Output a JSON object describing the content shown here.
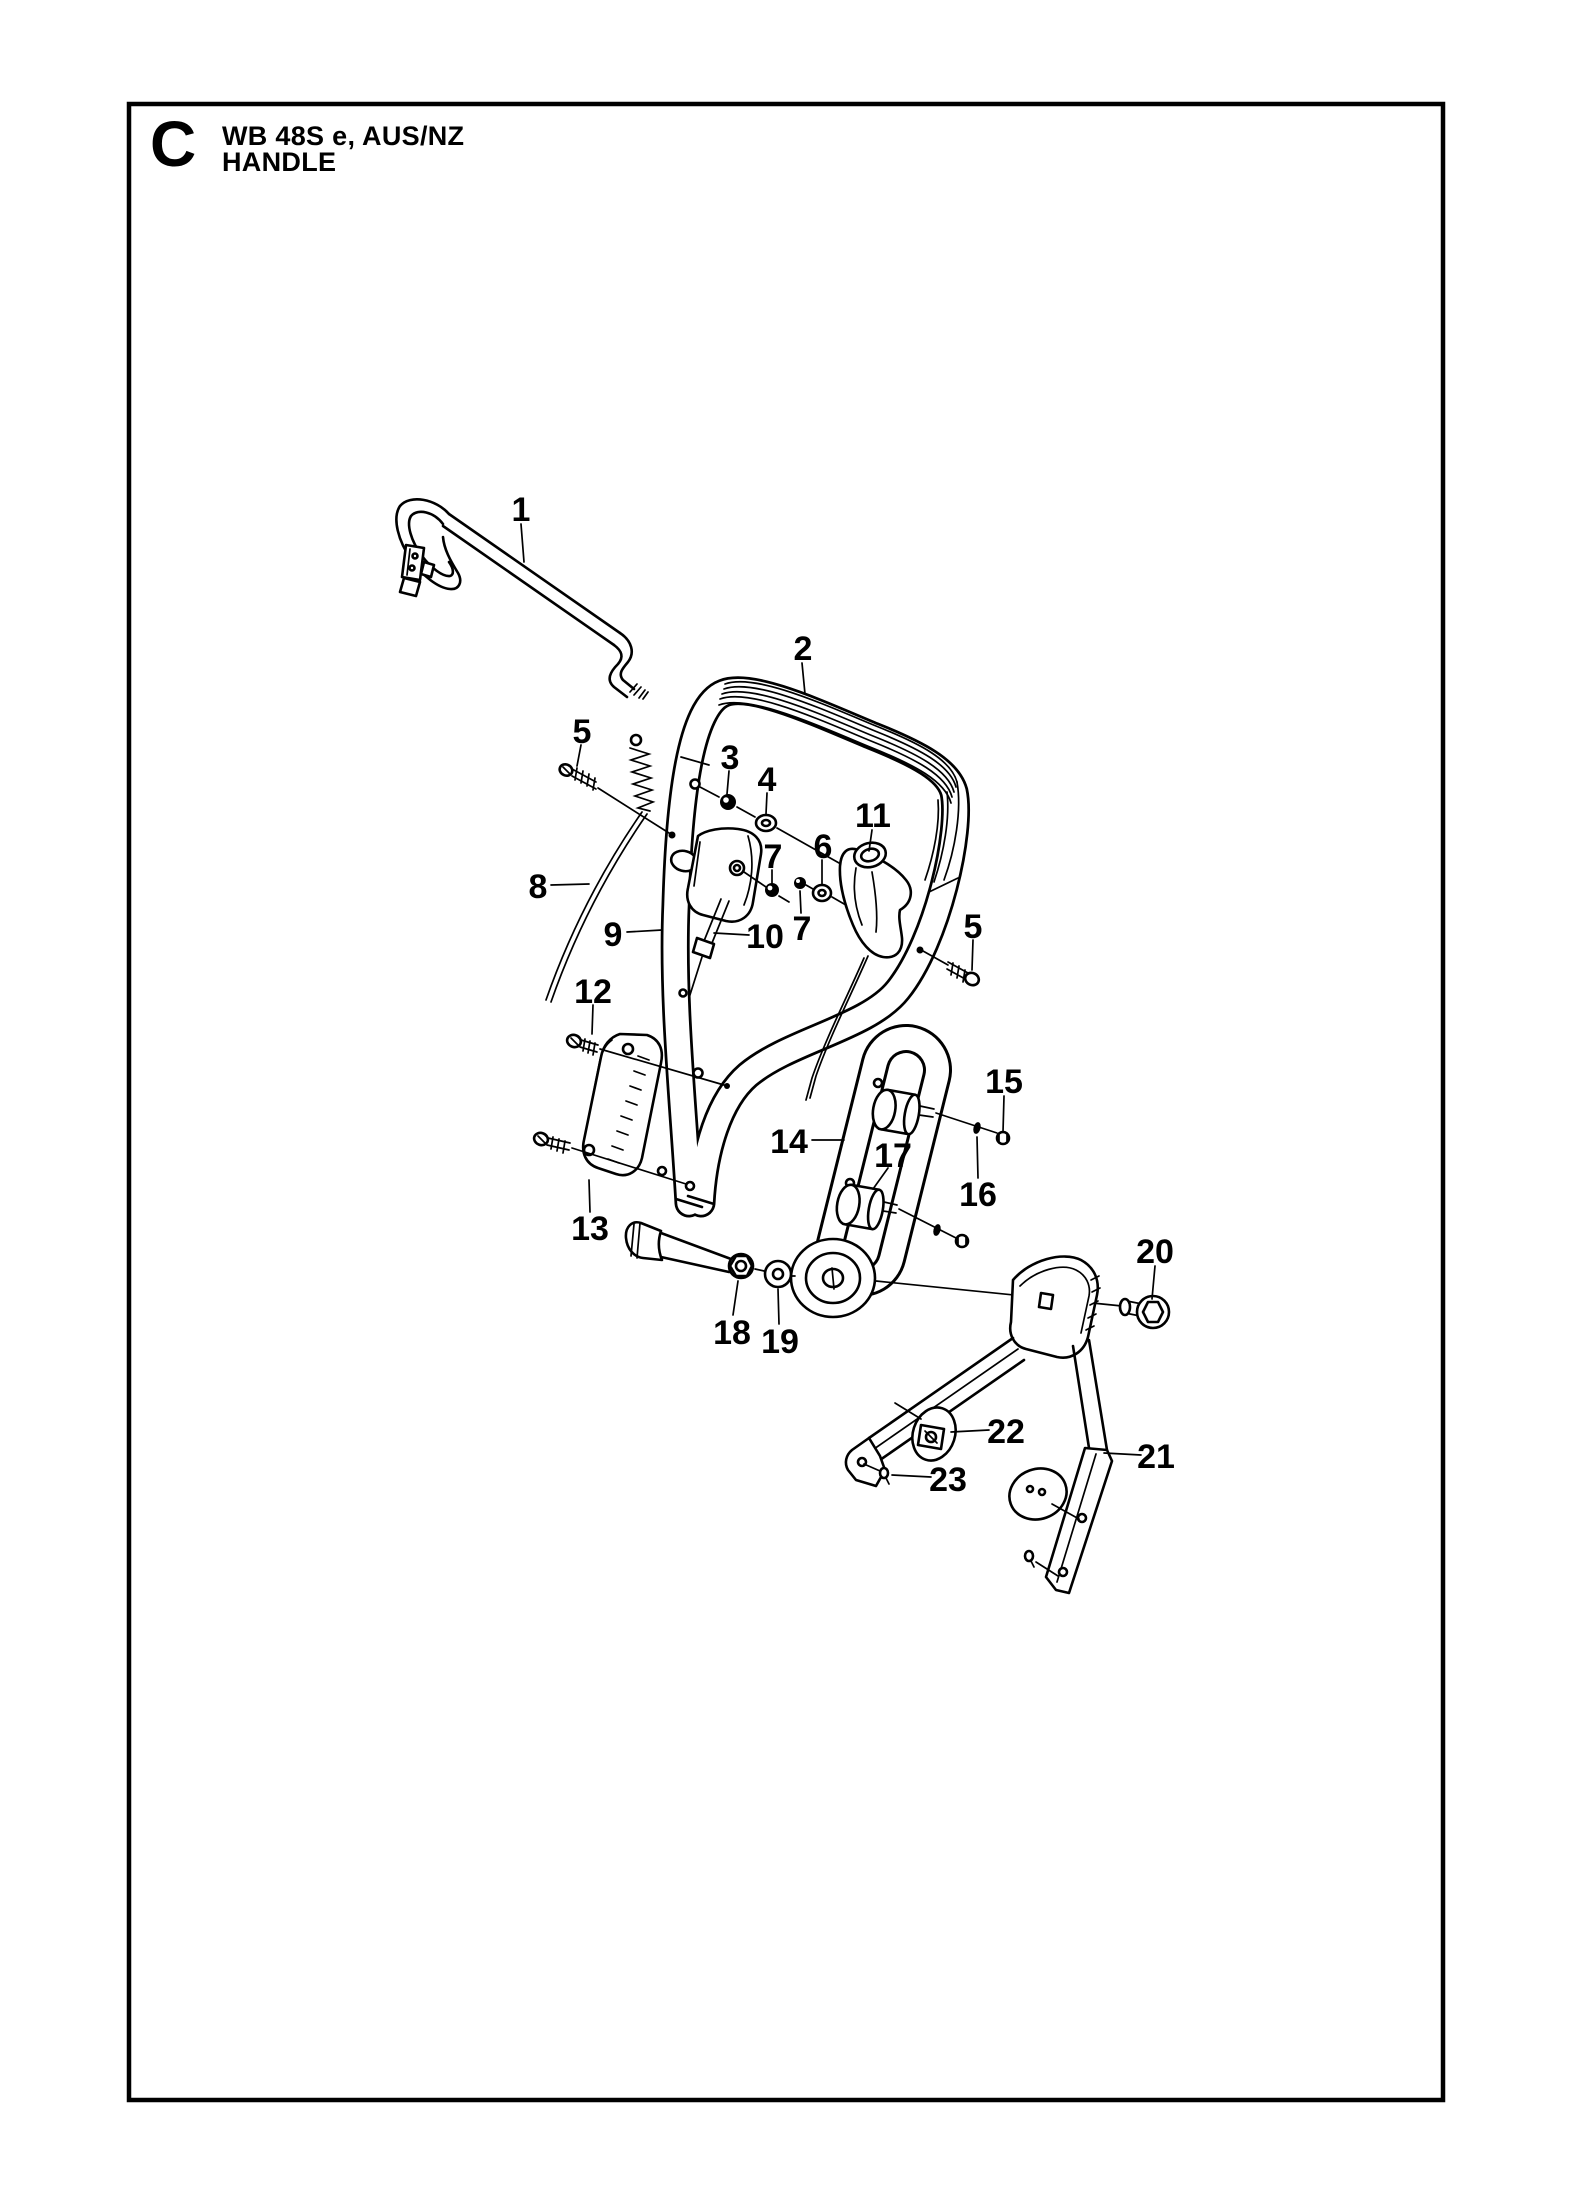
{
  "page": {
    "section_letter": "C",
    "title_line1": "WB 48S e, AUS/NZ",
    "title_line2": "HANDLE"
  },
  "diagram": {
    "type": "exploded-parts-diagram",
    "part_labels": [
      {
        "number": "1",
        "x": 521,
        "y": 509
      },
      {
        "number": "2",
        "x": 803,
        "y": 648
      },
      {
        "number": "3",
        "x": 730,
        "y": 757
      },
      {
        "number": "4",
        "x": 767,
        "y": 779
      },
      {
        "number": "5",
        "x": 582,
        "y": 731
      },
      {
        "number": "5",
        "x": 973,
        "y": 926
      },
      {
        "number": "6",
        "x": 823,
        "y": 846
      },
      {
        "number": "7",
        "x": 773,
        "y": 856
      },
      {
        "number": "7",
        "x": 802,
        "y": 928
      },
      {
        "number": "8",
        "x": 538,
        "y": 886
      },
      {
        "number": "9",
        "x": 613,
        "y": 934
      },
      {
        "number": "10",
        "x": 765,
        "y": 936
      },
      {
        "number": "11",
        "x": 873,
        "y": 815
      },
      {
        "number": "12",
        "x": 593,
        "y": 991
      },
      {
        "number": "13",
        "x": 590,
        "y": 1228
      },
      {
        "number": "14",
        "x": 789,
        "y": 1141
      },
      {
        "number": "15",
        "x": 1004,
        "y": 1081
      },
      {
        "number": "16",
        "x": 978,
        "y": 1194
      },
      {
        "number": "17",
        "x": 893,
        "y": 1155
      },
      {
        "number": "18",
        "x": 732,
        "y": 1332
      },
      {
        "number": "19",
        "x": 780,
        "y": 1341
      },
      {
        "number": "20",
        "x": 1155,
        "y": 1251
      },
      {
        "number": "21",
        "x": 1156,
        "y": 1456
      },
      {
        "number": "22",
        "x": 1006,
        "y": 1431
      },
      {
        "number": "23",
        "x": 948,
        "y": 1479
      }
    ]
  }
}
